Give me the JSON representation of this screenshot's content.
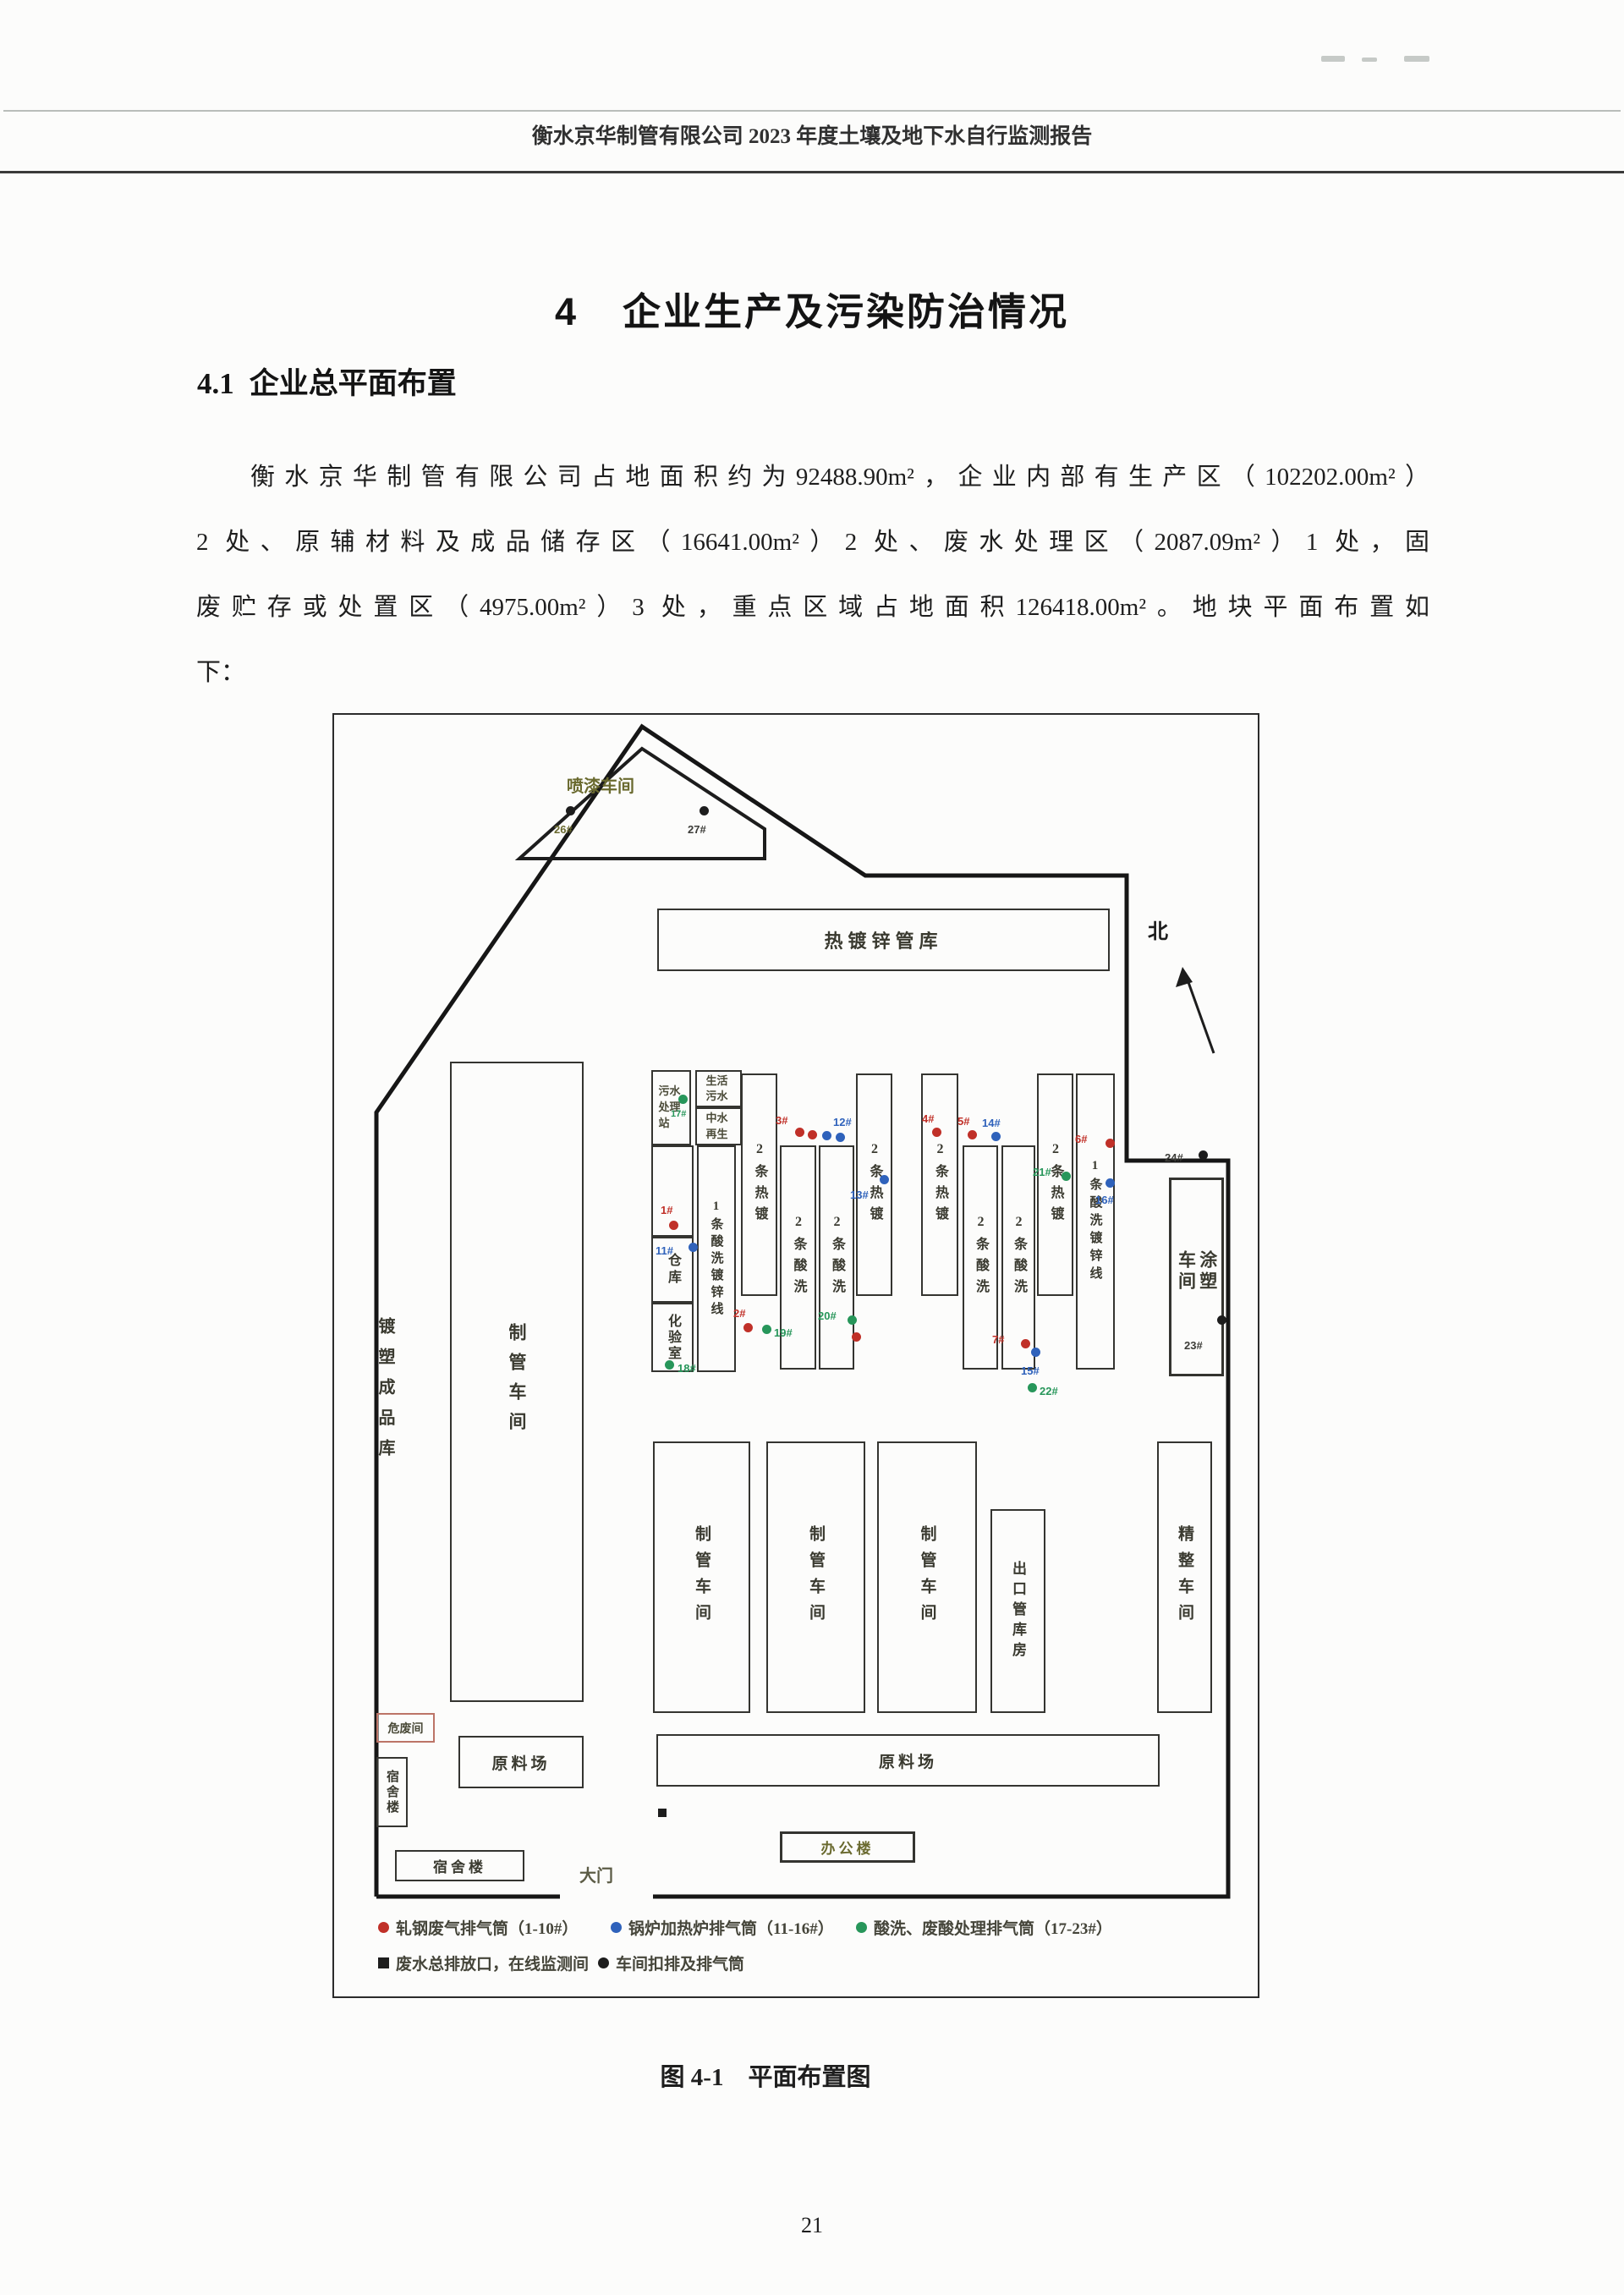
{
  "page": {
    "header": "衡水京华制管有限公司 2023 年度土壤及地下水自行监测报告",
    "chapter": {
      "num": "4",
      "title": "企业生产及污染防治情况"
    },
    "section": {
      "num": "4.1",
      "title": "企业总平面布置"
    },
    "paragraph_lines": [
      "衡水京华制管有限公司占地面积约为92488.90m²，企业内部有生产区（102202.00m²）",
      "2 处、原辅材料及成品储存区（16641.00m²）2 处、废水处理区（2087.09m²）1 处，固",
      "废贮存或处置区（4975.00m²）3 处，重点区域占地面积126418.00m²。地块平面布置如",
      "下："
    ],
    "caption": "图 4-1　平面布置图",
    "page_number": "21"
  },
  "figure": {
    "north_label": "北",
    "gate_label": "大门",
    "buildings": {
      "paint_shop": "喷漆车间",
      "galv_pipe_store": "热镀锌管库",
      "pipe_shop_main": "制管车间",
      "sewage": "污水处理站",
      "domestic": "生活污水",
      "reclaim": "中水再生",
      "warehouse": "仓库",
      "lab": "化验室",
      "strip1": "1条酸洗镀锌线",
      "strip2": "2条热镀",
      "strip3": "2条酸洗",
      "strip4": "2条酸洗",
      "strip5": "2条热镀",
      "strip6": "2条热镀",
      "strip7": "2条酸洗",
      "strip8": "2条酸洗",
      "strip9": "2条热镀",
      "strip10": "1条酸洗镀锌线",
      "coating": "涂塑车间",
      "pipe_a": "制管车间",
      "pipe_b": "制管车间",
      "pipe_c": "制管车间",
      "export_store": "出口管库房",
      "finishing": "精整车间",
      "raw_small": "原料场",
      "raw_big": "原料场",
      "hazwaste": "危废间",
      "dorm_v": "宿舍楼",
      "dorm_h": "宿舍楼",
      "office": "办公楼",
      "product_store": "镀塑成品库"
    },
    "stack_labels": {
      "s26": "26#",
      "s27": "27#",
      "s24": "24#",
      "s23": "23#",
      "s17": "17#",
      "s18": "18#",
      "s19": "19#",
      "s20": "20#",
      "s21": "21#",
      "s22": "22#",
      "s1": "1#",
      "s2": "2#",
      "s3": "3#",
      "s4": "4#",
      "s5": "5#",
      "s6": "6#",
      "s7": "7#",
      "s11": "11#",
      "s12": "12#",
      "s13": "13#",
      "s14": "14#",
      "s15": "15#",
      "s16": "16#"
    },
    "legend": {
      "items": [
        {
          "marker": "red-dot",
          "text": "轧钢废气排气筒（1-10#）"
        },
        {
          "marker": "blue-dot",
          "text": "锅炉加热炉排气筒（11-16#）"
        },
        {
          "marker": "green-dot",
          "text": "酸洗、废酸处理排气筒（17-23#）"
        },
        {
          "marker": "black-square",
          "text": "废水总排放口，在线监测间"
        },
        {
          "marker": "black-dot",
          "text": "车间扣排及排气筒"
        }
      ]
    },
    "colors": {
      "red_stack": "#c03028",
      "blue_stack": "#2f62bb",
      "green_stack": "#27965a",
      "black_stack": "#1d1d1d",
      "olive_label": "#6a6a2f"
    }
  }
}
